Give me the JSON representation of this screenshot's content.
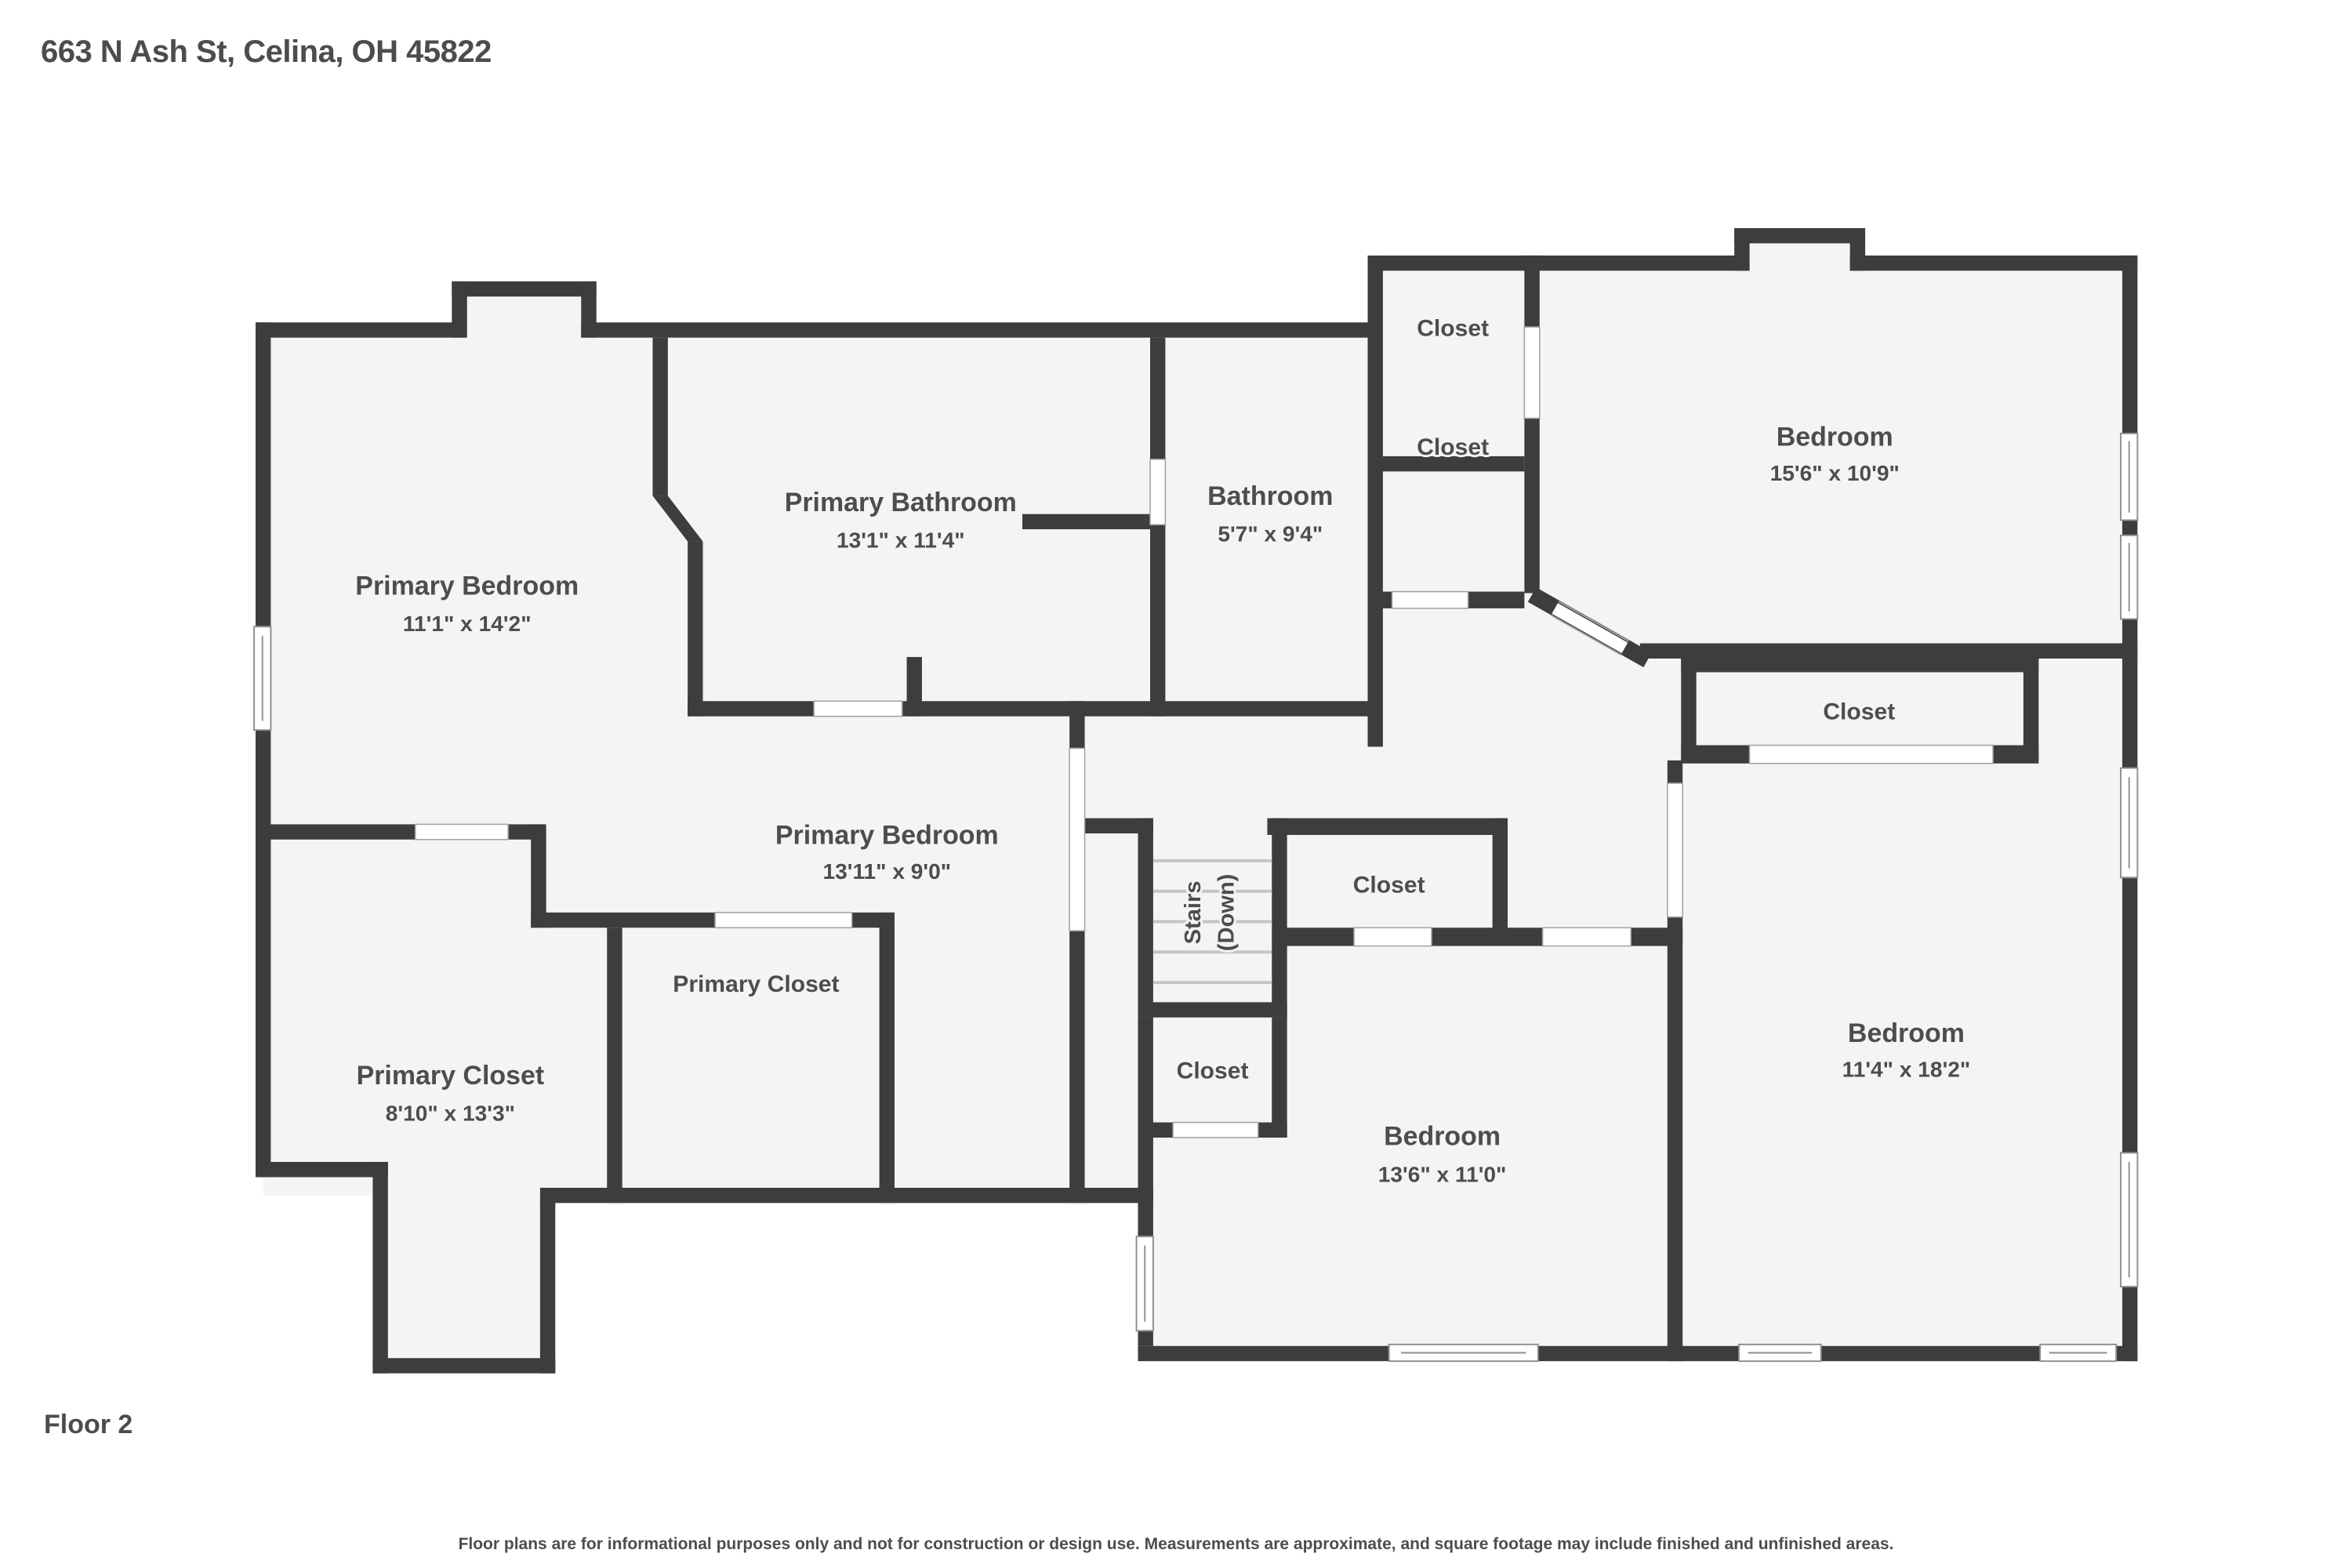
{
  "header": {
    "address": "663 N Ash St, Celina, OH 45822"
  },
  "floor": {
    "label": "Floor 2"
  },
  "footer": {
    "disclaimer": "Floor plans are for informational purposes only and not for construction or design use. Measurements are approximate, and square footage may include finished and unfinished areas."
  },
  "colors": {
    "wall": "#3d3d3d",
    "floor": "#f4f4f4",
    "label": "#4d4d4d",
    "background": "#ffffff"
  },
  "rooms": [
    {
      "id": "primary-bedroom-1",
      "name": "Primary Bedroom",
      "dims": "11'1\" x 14'2\""
    },
    {
      "id": "primary-bathroom",
      "name": "Primary Bathroom",
      "dims": "13'1\" x 11'4\""
    },
    {
      "id": "bathroom",
      "name": "Bathroom",
      "dims": "5'7\" x 9'4\""
    },
    {
      "id": "closet-top-1",
      "name": "Closet"
    },
    {
      "id": "closet-top-2",
      "name": "Closet"
    },
    {
      "id": "bedroom-top-right",
      "name": "Bedroom",
      "dims": "15'6\" x 10'9\""
    },
    {
      "id": "closet-right",
      "name": "Closet"
    },
    {
      "id": "primary-bedroom-2",
      "name": "Primary Bedroom",
      "dims": "13'11\" x 9'0\""
    },
    {
      "id": "stairs",
      "name": "Stairs",
      "sub": "(Down)"
    },
    {
      "id": "closet-by-stairs",
      "name": "Closet"
    },
    {
      "id": "primary-closet-upper",
      "name": "Primary Closet"
    },
    {
      "id": "primary-closet-lower",
      "name": "Primary Closet",
      "dims": "8'10\" x 13'3\""
    },
    {
      "id": "closet-below-stairs",
      "name": "Closet"
    },
    {
      "id": "bedroom-bottom-middle",
      "name": "Bedroom",
      "dims": "13'6\" x 11'0\""
    },
    {
      "id": "bedroom-bottom-right",
      "name": "Bedroom",
      "dims": "11'4\" x 18'2\""
    }
  ]
}
